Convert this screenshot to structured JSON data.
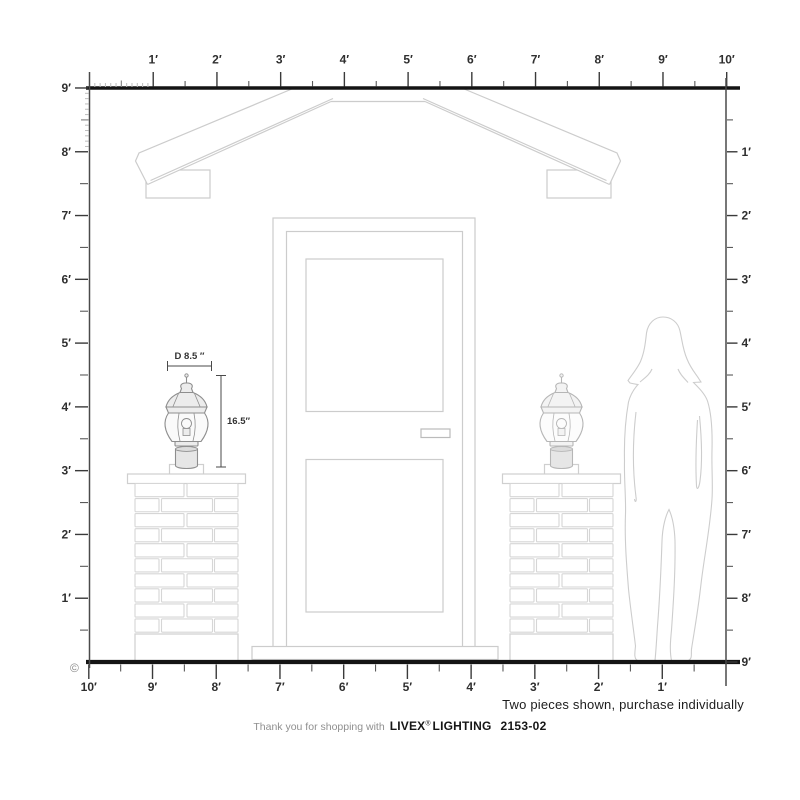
{
  "rulers": {
    "unit": "feet",
    "top": {
      "labels": [
        "1′",
        "2′",
        "3′",
        "4′",
        "5′",
        "6′",
        "7′",
        "8′",
        "9′",
        "10′"
      ]
    },
    "bottom": {
      "labels": [
        "10′",
        "9′",
        "8′",
        "7′",
        "6′",
        "5′",
        "4′",
        "3′",
        "2′",
        "1′"
      ]
    },
    "left": {
      "labels": [
        "9′",
        "8′",
        "7′",
        "6′",
        "5′",
        "4′",
        "3′",
        "2′",
        "1′"
      ]
    },
    "right": {
      "labels": [
        "1′",
        "2′",
        "3′",
        "4′",
        "5′",
        "6′",
        "7′",
        "8′",
        "9′"
      ]
    }
  },
  "annotations": {
    "diameter_label": "D 8.5 ″",
    "height_label": "16.5″",
    "note": "Two pieces shown, purchase individually",
    "copyright": "©"
  },
  "footer": {
    "prefix": "Thank you for shopping with",
    "brand": "LIVEX",
    "registered": "®",
    "brand_suffix": "LIGHTING",
    "model": "2153-02"
  },
  "colors": {
    "ruler_line": "#141414",
    "axis_line": "#4a4a4a",
    "tick_major": "#3a3a3a",
    "tick_minor": "#5a5a5a",
    "tick_inch": "#bdbdbd",
    "label_text": "#2f2f2f",
    "line_art": "#cccccc",
    "brick_line": "#d6d6d6",
    "lamp_dark": "#8e8e8e",
    "lamp_light": "#b6b6b6",
    "dimension_line": "#4a4a4a",
    "silhouette": "#cdcdcd"
  }
}
